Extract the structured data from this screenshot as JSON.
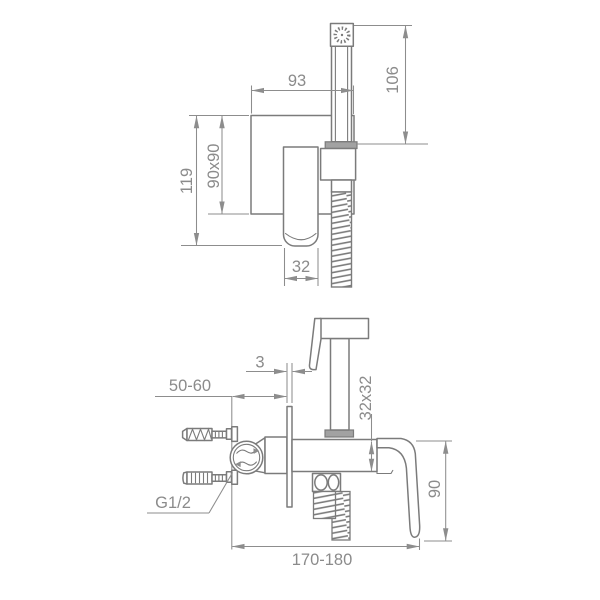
{
  "page": {
    "background": "#ffffff"
  },
  "drawing": {
    "kind": "technical dimension drawing",
    "subject": "wall-mounted bidet hand-shower mixer set, front view and side view",
    "colors": {
      "object_line": "#7b7b7b",
      "dimension_line": "#8d8d8d",
      "text": "#8b8b8b",
      "background": "#ffffff"
    },
    "front_view": {
      "dim_spray_offset": "93",
      "dim_shower_height": "106",
      "dim_overall_height": "119",
      "dim_plate_size": "90x90",
      "dim_handle_width": "32"
    },
    "side_view": {
      "dim_plate_thickness": "3",
      "dim_inlet_depth": "50-60",
      "dim_body_section": "32x32",
      "dim_lever_height": "90",
      "dim_overall_depth": "170-180",
      "thread_label": "G1/2"
    }
  }
}
